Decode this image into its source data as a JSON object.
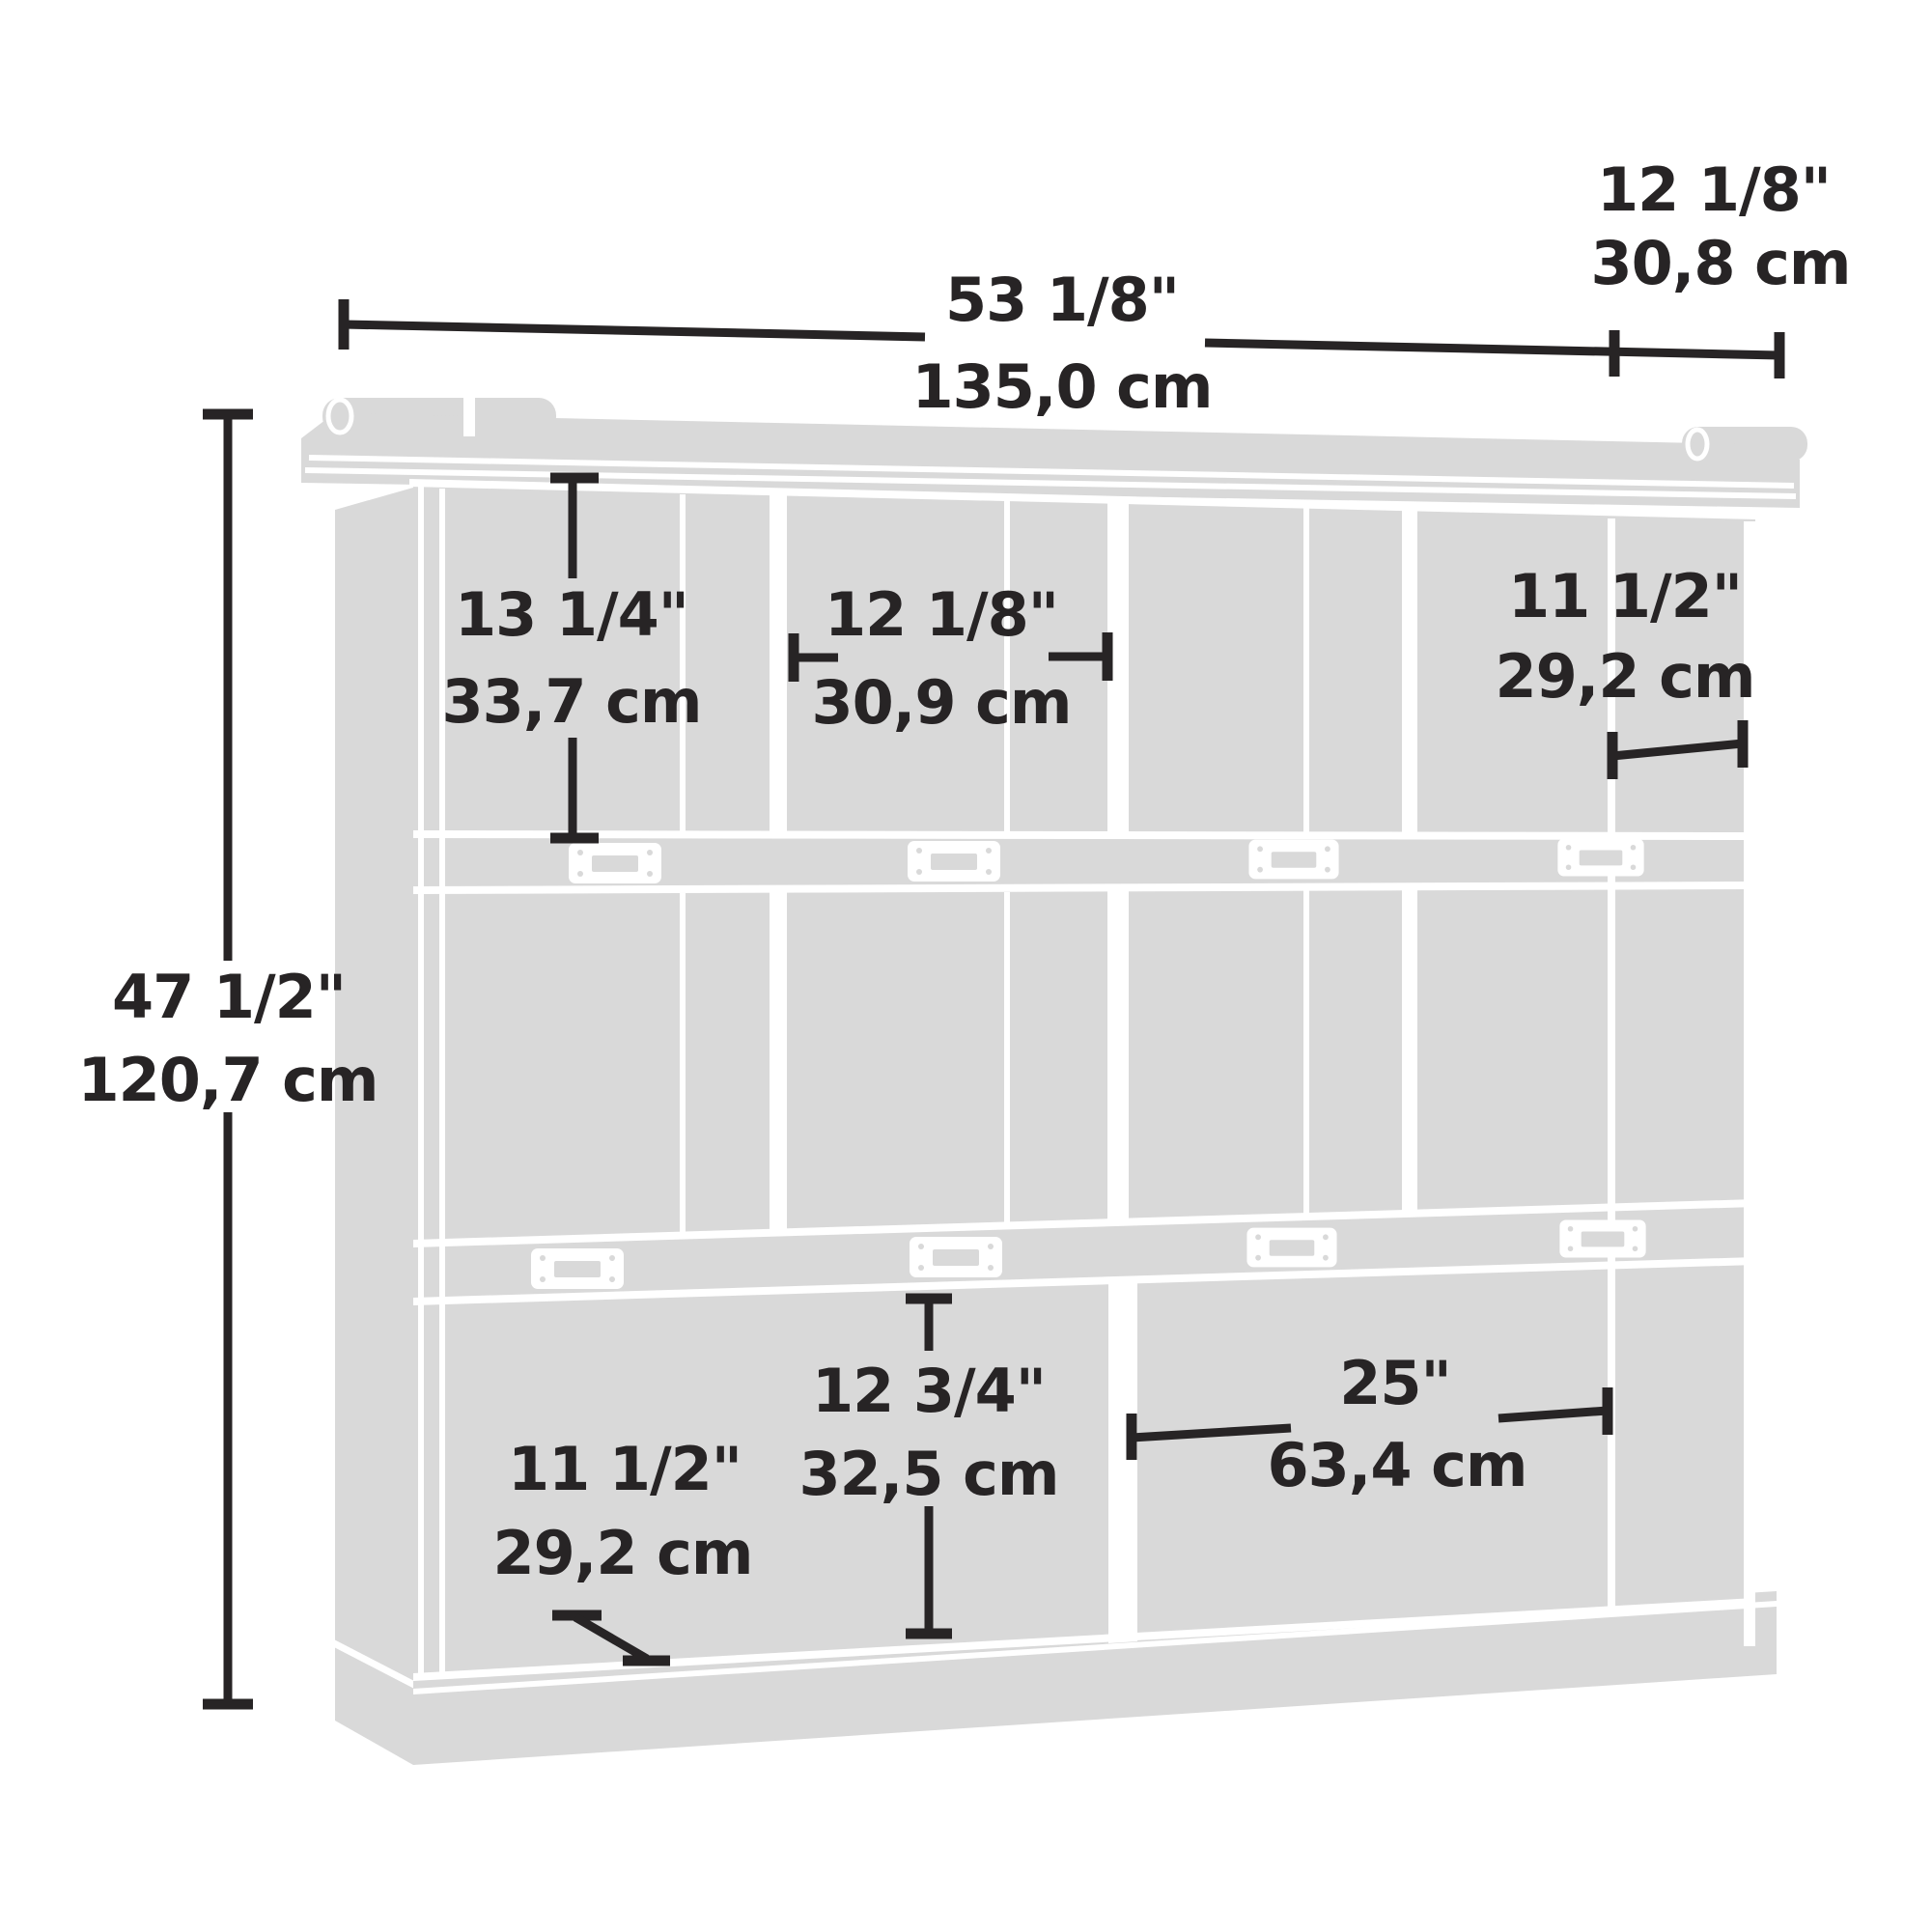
{
  "diagram": {
    "title": "storage-bookcase-dimension-diagram",
    "type": "furniture-dimension-line-drawing",
    "colors": {
      "furniture_gray": "#d9d9d9",
      "line_white": "#ffffff",
      "dimension_black": "#272425",
      "background": "#ffffff"
    },
    "structure": {
      "rows": 3,
      "top_row_cubbies": 4,
      "middle_row_cubbies": 4,
      "bottom_row_openings": 2,
      "shelf_label_plates_per_shelf": 4
    },
    "dimensions": {
      "overall_width": {
        "inches": "53 1/8\"",
        "cm": "135,0 cm"
      },
      "overall_depth": {
        "inches": "12 1/8\"",
        "cm": "30,8 cm"
      },
      "overall_height": {
        "inches": "47 1/2\"",
        "cm": "120,7 cm"
      },
      "top_cubby_height": {
        "inches": "13 1/4\"",
        "cm": "33,7 cm"
      },
      "top_cubby_width": {
        "inches": "12 1/8\"",
        "cm": "30,9 cm"
      },
      "cubby_depth": {
        "inches": "11 1/2\"",
        "cm": "29,2 cm"
      },
      "bottom_cubby_height": {
        "inches": "12 3/4\"",
        "cm": "32,5 cm"
      },
      "bottom_opening_width": {
        "inches": "25\"",
        "cm": "63,4 cm"
      },
      "bottom_shelf_depth": {
        "inches": "11 1/2\"",
        "cm": "29,2 cm"
      }
    }
  }
}
